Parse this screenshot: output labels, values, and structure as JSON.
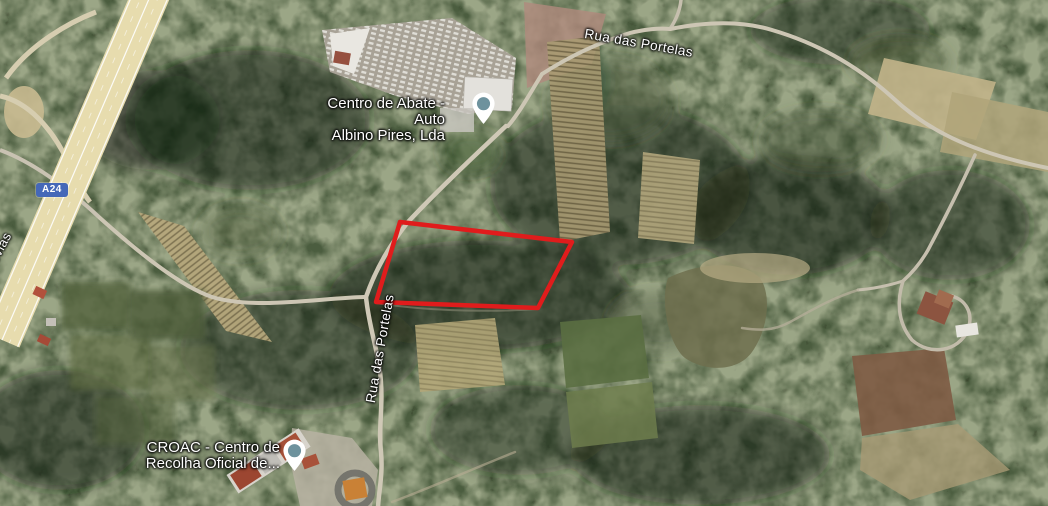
{
  "map": {
    "road_labels": {
      "top": "Rua das Portelas",
      "side": "Rua das Portelas",
      "edge_fragment": "ovias"
    },
    "highway": {
      "shield": "A24"
    },
    "pois": [
      {
        "name_line1": "Centro de Abate -Auto",
        "name_line2": "Albino Pires, Lda"
      },
      {
        "name_line1": "CROAC - Centro de",
        "name_line2": "Recolha Oficial de..."
      }
    ],
    "parcel": {
      "points": "400,222 572,242 538,308 376,302",
      "color": "#e01c1c"
    },
    "colors": {
      "forest": "#333f28",
      "field_tan": "#b6a87c",
      "road": "#cdc6b4",
      "highway": "#e7dcae",
      "shield_blue": "#4568b8",
      "pin_inner": "#6e929d"
    }
  }
}
